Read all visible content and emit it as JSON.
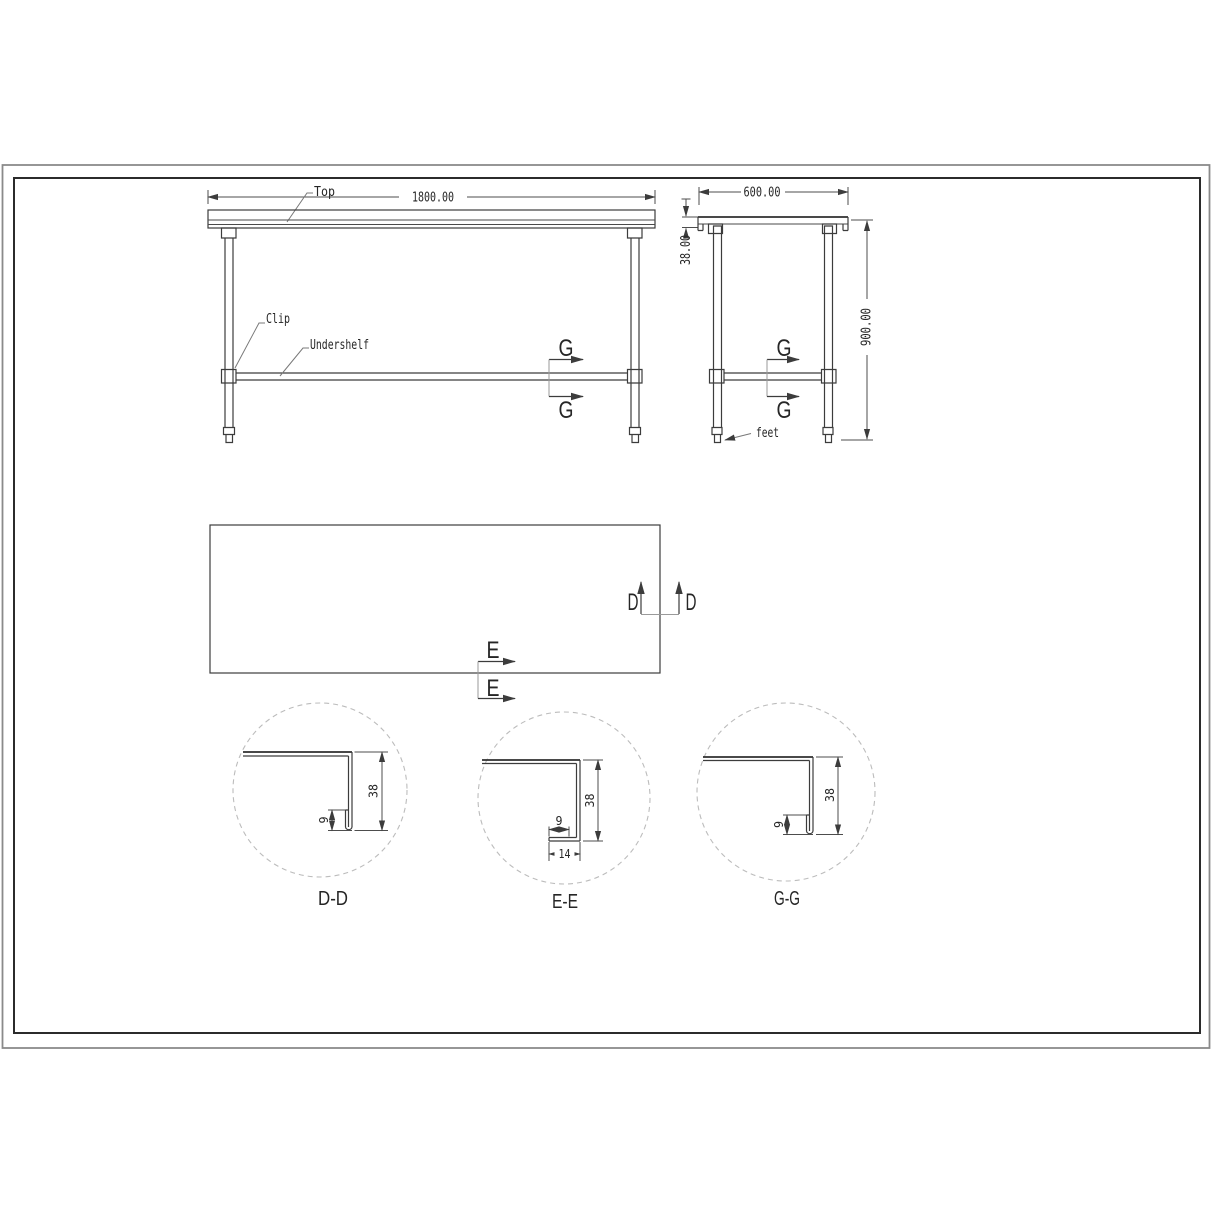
{
  "front_view": {
    "dim_length": "1800.00",
    "labels": {
      "top": "Top",
      "clip": "Clip",
      "undershelf": "Undershelf"
    },
    "section_letter": "G"
  },
  "side_view": {
    "dim_depth": "600.00",
    "dim_top_thickness": "38.00",
    "dim_height": "900.00",
    "labels": {
      "feet": "feet"
    },
    "section_letter": "G"
  },
  "plan_view": {
    "section_d": "D",
    "section_e": "E"
  },
  "details": [
    {
      "label": "D-D",
      "dim_height": "38",
      "dim_hem": "9"
    },
    {
      "label": "E-E",
      "dim_height": "38",
      "dim_return": "9",
      "dim_flange": "14"
    },
    {
      "label": "G-G",
      "dim_height": "38",
      "dim_hem": "9"
    }
  ],
  "colors": {
    "line": "#3c3c3c",
    "dimension": "#4d4d4d",
    "dashed_circle": "#bcbcbc",
    "border_outer": "#8a8a8a",
    "border_inner": "#2b2b2b",
    "background": "#ffffff"
  }
}
